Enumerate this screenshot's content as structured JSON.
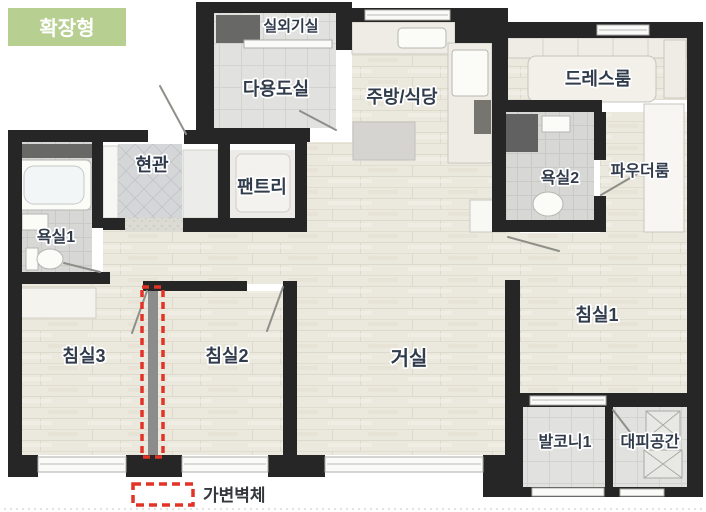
{
  "badge": {
    "label": "확장형"
  },
  "legend": {
    "label": "가변벽체",
    "swatch": "movable-wall-dashed"
  },
  "rooms": {
    "outdoor_unit": "실외기실",
    "utility": "다용도실",
    "kitchen_dining": "주방/식당",
    "dress_room": "드레스룸",
    "entrance": "현관",
    "pantry": "팬트리",
    "bathroom2": "욕실2",
    "powder_room": "파우더룸",
    "bathroom1": "욕실1",
    "bedroom3": "침실3",
    "bedroom2": "침실2",
    "living_room": "거실",
    "bedroom1": "침실1",
    "balcony1": "발코니1",
    "refuge_space": "대피공간"
  },
  "colors": {
    "badge_bg": "#b7cf90",
    "wall": "#262626",
    "movable_wall_red": "#e23426",
    "label_text": "#303b4b",
    "wood_floor": "#ebe8dd",
    "tile_floor": "#e1e1df"
  }
}
